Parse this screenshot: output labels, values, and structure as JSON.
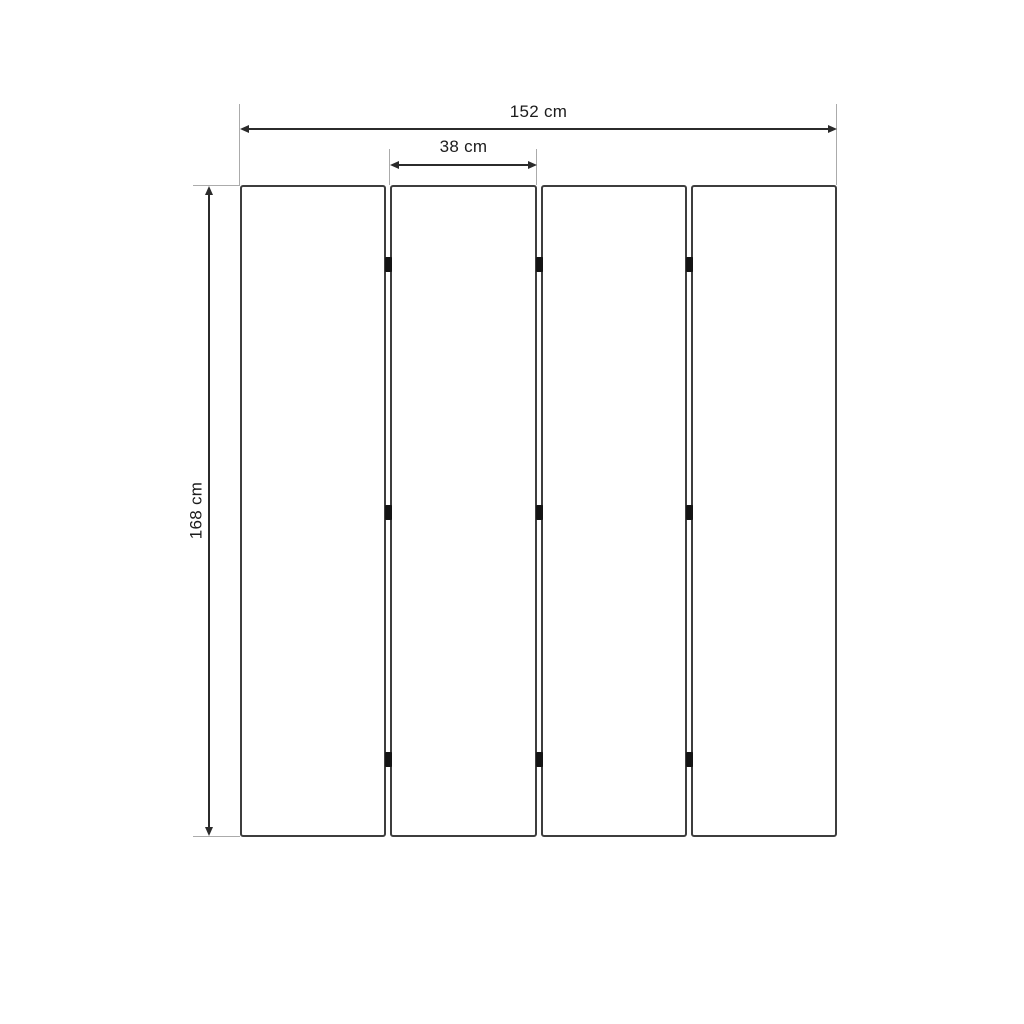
{
  "diagram": {
    "type": "dimension-drawing",
    "subject": "four-panel folding screen with hinges",
    "panel_count": 4,
    "gap_count": 3,
    "hinges_per_gap": 3,
    "labels": {
      "total_width": "152 cm",
      "panel_width": "38 cm",
      "height": "168 cm"
    },
    "values": {
      "total_width_cm": 152,
      "panel_width_cm": 38,
      "height_cm": 168,
      "unit": "cm"
    },
    "colors": {
      "background": "#ffffff",
      "panel_fill": "#ffffff",
      "panel_border": "#3e3e3e",
      "dimension_line": "#2b2b2b",
      "extension_line": "#ababab",
      "hinge": "#141414",
      "text": "#1c1c1c"
    }
  }
}
